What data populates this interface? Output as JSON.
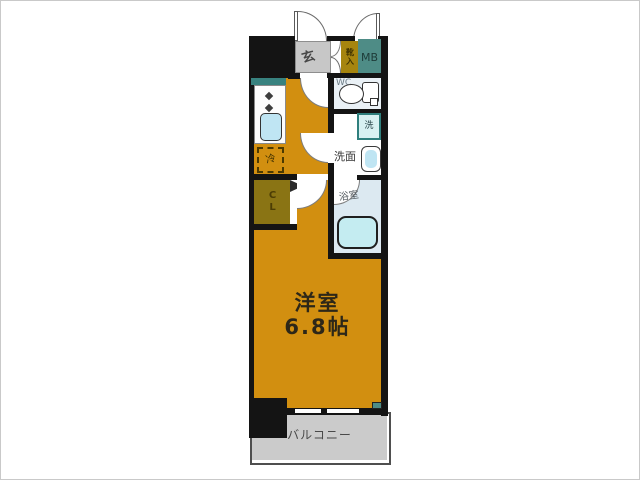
{
  "labels": {
    "entrance": "玄",
    "shoe_cabinet": "靴入",
    "meter_box": "MB",
    "toilet": "WC",
    "washer": "洗",
    "washroom": "洗面",
    "bathroom": "浴室",
    "refrigerator": "冷",
    "closet": "CL",
    "balcony": "バルコニー"
  },
  "main_room": {
    "name": "洋室",
    "size": "6.8帖"
  },
  "colors": {
    "room_orange": "#D28F10",
    "closet_olive": "#8A7414",
    "shoe_olive": "#A6850F",
    "meter_teal": "#4E8C86",
    "counter_teal": "#38827F",
    "entry_gray": "#C7C7C7",
    "balcony_gray": "#CBCBCB",
    "wall_black": "#141414",
    "wc_floor": "#EAF1F6",
    "bath_floor": "#DCE9F1",
    "fixture_blue": "#BFE5F3",
    "tub_cyan": "#C4ECF1",
    "washer_fill": "#D8F1F2"
  }
}
